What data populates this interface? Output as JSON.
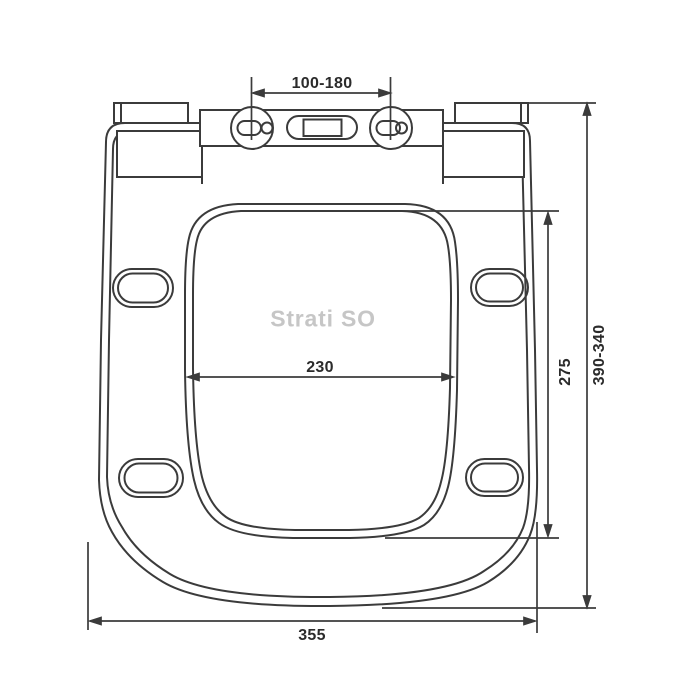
{
  "page": {
    "background": "#ffffff"
  },
  "drawing": {
    "product_name": "Strati SO",
    "dimensions": {
      "hinge_spacing": "100-180",
      "inner_width": "230",
      "inner_length": "275",
      "overall_length_range": "390-340",
      "overall_width": "355"
    },
    "colors": {
      "line": "#3b3b3b",
      "dimension_line": "#3b3b3b",
      "dimension_text": "#2b2b2b",
      "product_name_text": "#c6c6c6"
    }
  }
}
